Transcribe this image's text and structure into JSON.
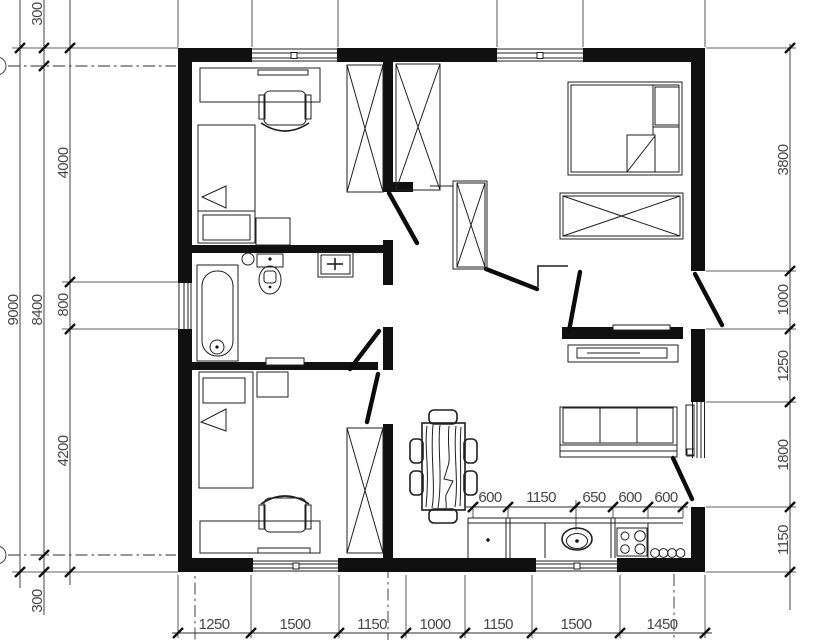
{
  "drawing": {
    "type": "floor-plan",
    "colors": {
      "wall": "#101010",
      "line": "#1f1f1f",
      "dim_line": "#2e2e2e",
      "dim_text": "#474747",
      "background": "#ffffff"
    }
  },
  "dimensions": {
    "left_overall": "9000",
    "left_wall_chain": [
      "300",
      "8400",
      "300"
    ],
    "left_rooms_chain": [
      "4000",
      "800",
      "4200"
    ],
    "right_chain": [
      "3800",
      "1000",
      "1250",
      "1800",
      "1150"
    ],
    "bottom_chain": [
      "1250",
      "1500",
      "1150",
      "1000",
      "1150",
      "1500",
      "1450"
    ],
    "kitchen_chain": [
      "600",
      "1150",
      "650",
      "600",
      "600"
    ]
  }
}
